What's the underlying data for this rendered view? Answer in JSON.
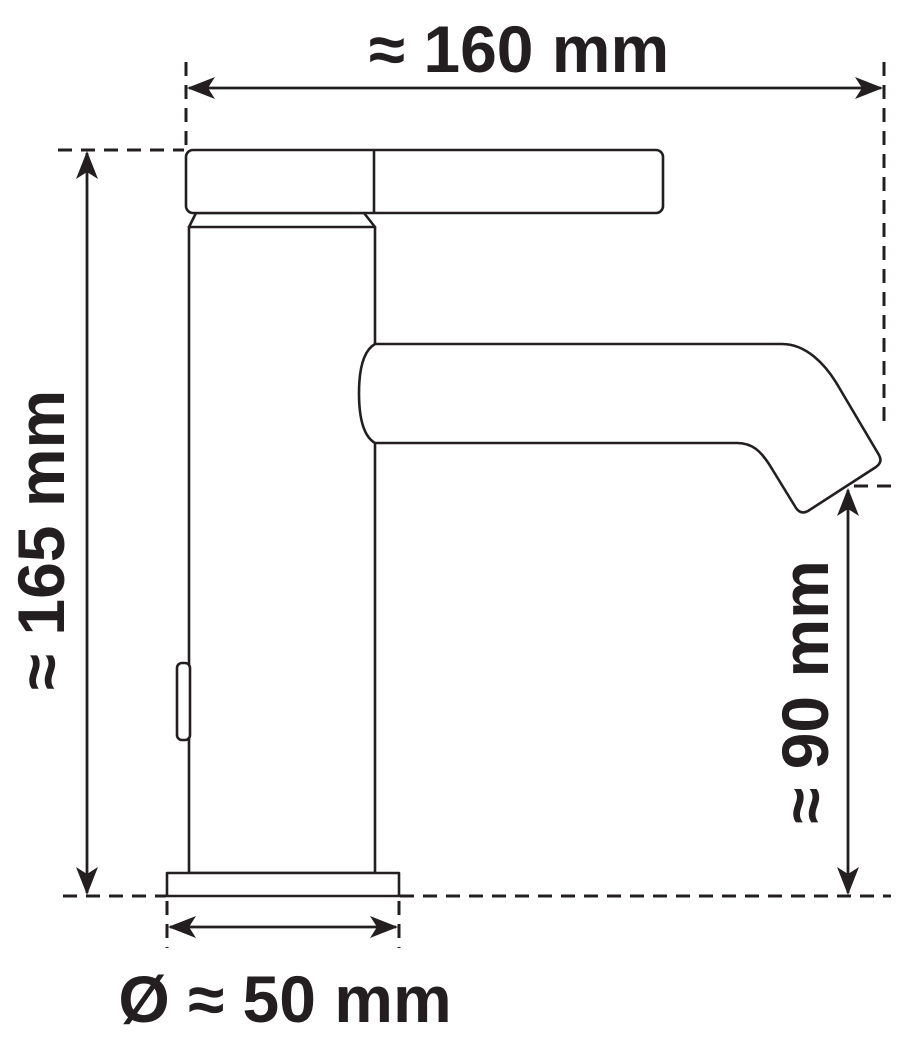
{
  "drawing": {
    "subject": "basin-faucet-side-view-dimension-drawing",
    "line_color": "#231f20",
    "background_color": "#ffffff",
    "labels": {
      "overall_width_top": "≈ 160 mm",
      "overall_height_left": "≈ 165 mm",
      "spout_height_right": "≈ 90 mm",
      "base_diameter_bottom": "Ø ≈ 50 mm"
    }
  }
}
